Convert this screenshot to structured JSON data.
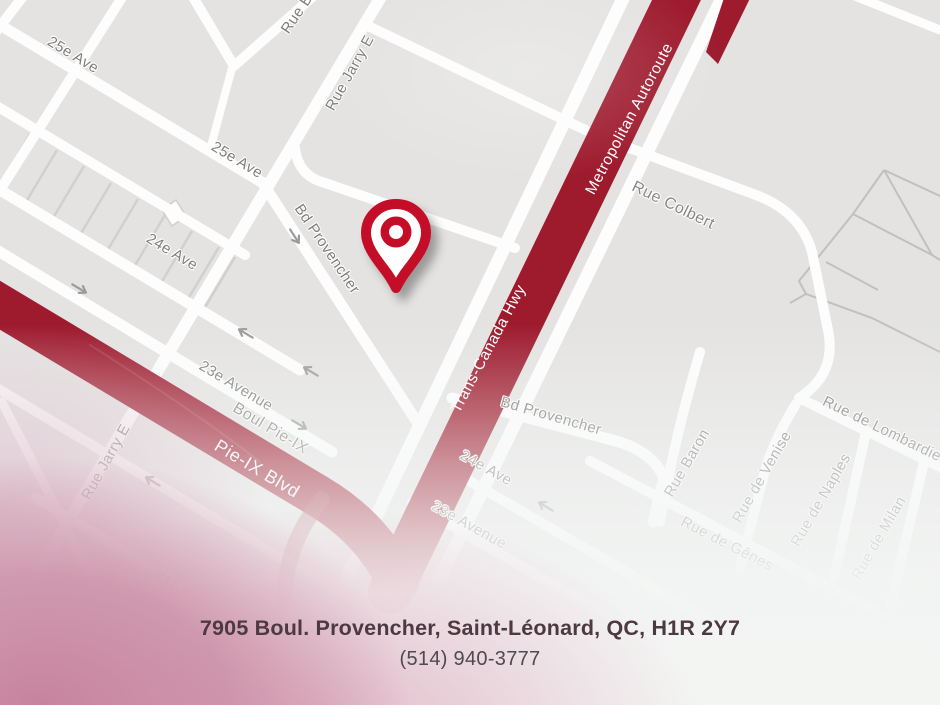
{
  "map": {
    "colors": {
      "background": "#e4e3e2",
      "road": "#ffffff",
      "highway_red": "#9e1b2e",
      "pin_red": "#c40d28",
      "street_label": "#7f7c79"
    },
    "pin": {
      "x": 396,
      "y": 234,
      "name": "location-pin"
    },
    "labels": [
      {
        "text": "25e Ave",
        "x": 73,
        "y": 55,
        "rot": 31,
        "kind": "street"
      },
      {
        "text": "25e Ave",
        "x": 237,
        "y": 160,
        "rot": 31,
        "kind": "street"
      },
      {
        "text": "Rue B",
        "x": 297,
        "y": 14,
        "rot": -56,
        "kind": "street"
      },
      {
        "text": "Rue Jarry E",
        "x": 350,
        "y": 73,
        "rot": -61,
        "kind": "street"
      },
      {
        "text": "Bd Provencher",
        "x": 327,
        "y": 249,
        "rot": 56,
        "kind": "street"
      },
      {
        "text": "24e Ave",
        "x": 172,
        "y": 252,
        "rot": 31,
        "kind": "street"
      },
      {
        "text": "23e Avenue",
        "x": 236,
        "y": 386,
        "rot": 31,
        "kind": "street"
      },
      {
        "text": "Boul Pie-IX",
        "x": 270,
        "y": 429,
        "rot": 31,
        "kind": "street-lg"
      },
      {
        "text": "Pie-IX Blvd",
        "x": 257,
        "y": 469,
        "rot": 31,
        "kind": "hwy-lg"
      },
      {
        "text": "Rue Jarry E",
        "x": 106,
        "y": 462,
        "rot": -61,
        "kind": "street"
      },
      {
        "text": "21e Ave",
        "x": 180,
        "y": 589,
        "rot": 31,
        "kind": "street"
      },
      {
        "text": "Metropolitan Autoroute",
        "x": 630,
        "y": 119,
        "rot": -62,
        "kind": "hwy"
      },
      {
        "text": "Trans-Canada Hwy",
        "x": 489,
        "y": 349,
        "rot": -62,
        "kind": "hwy"
      },
      {
        "text": "Rue Colbert",
        "x": 673,
        "y": 206,
        "rot": 26,
        "kind": "street-lg"
      },
      {
        "text": "Bd Provencher",
        "x": 551,
        "y": 416,
        "rot": 16,
        "kind": "street"
      },
      {
        "text": "24e Ave",
        "x": 486,
        "y": 468,
        "rot": 29,
        "kind": "street"
      },
      {
        "text": "23e Avenue",
        "x": 469,
        "y": 525,
        "rot": 29,
        "kind": "street"
      },
      {
        "text": "Rue Baron",
        "x": 687,
        "y": 463,
        "rot": -60,
        "kind": "street"
      },
      {
        "text": "Rue de Venise",
        "x": 762,
        "y": 477,
        "rot": -60,
        "kind": "street"
      },
      {
        "text": "Rue de Naples",
        "x": 821,
        "y": 500,
        "rot": -60,
        "kind": "street"
      },
      {
        "text": "Rue de Milan",
        "x": 879,
        "y": 538,
        "rot": -60,
        "kind": "street"
      },
      {
        "text": "Rue de Lombardie",
        "x": 882,
        "y": 429,
        "rot": 26,
        "kind": "street"
      },
      {
        "text": "Rue de Gênes",
        "x": 727,
        "y": 544,
        "rot": 27,
        "kind": "street"
      }
    ]
  },
  "footer": {
    "address": "7905 Boul. Provencher, Saint-Léonard, QC, H1R 2Y7",
    "phone": "(514) 940-3777"
  }
}
